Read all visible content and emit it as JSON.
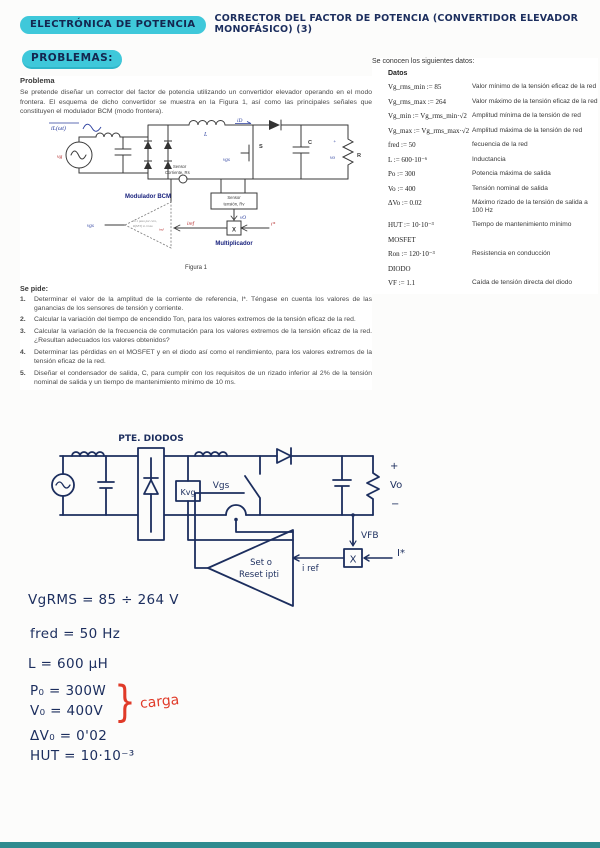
{
  "header": {
    "course": "ELECTRÓNICA DE POTENCIA",
    "title": "CORRECTOR DEL FACTOR DE POTENCIA (CONVERTIDOR ELEVADOR MONOFÁSICO) (3)",
    "section": "PROBLEMAS:"
  },
  "problem": {
    "heading": "Problema",
    "body": "Se pretende diseñar un corrector del factor de potencia utilizando un convertidor elevador operando en el modo frontera. El esquema de dicho convertidor se muestra en la Figura 1, así como las principales señales que constituyen el modulador BCM (modo frontera).",
    "figure": {
      "caption": "Figura 1",
      "labels": {
        "il": "iL(ωt)",
        "vg": "vg",
        "L": "L",
        "id": "iD",
        "S": "S",
        "vgs": "vgs",
        "C": "C",
        "vo": "vo",
        "plus": "+",
        "R": "R",
        "sensor_i_1": "Sensor",
        "sensor_i_2": "Corriente, Rs",
        "sensor_v_1": "Sensor",
        "sensor_v_2": "tensión, Rv",
        "vO": "vO",
        "modulador": "Modulador BCM",
        "mod_line1": "S=1 paso por cero,",
        "mod_line2": "R(SET) si cruza",
        "mod_iref": "iref",
        "iref": "iref",
        "istar": "i*",
        "x": "X",
        "multiplicador": "Multiplicador"
      }
    },
    "se_pide": {
      "heading": "Se pide:",
      "items": [
        {
          "num": "1.",
          "text": "Determinar el valor de la amplitud de la corriente de referencia, I*. Téngase en cuenta los valores de las ganancias de los sensores de tensión y corriente."
        },
        {
          "num": "2.",
          "text": "Calcular la variación del tiempo de encendido Ton, para los valores extremos de la tensión eficaz de la red."
        },
        {
          "num": "3.",
          "text": "Calcular la variación de la frecuencia de conmutación para los valores extremos de la tensión eficaz de la red. ¿Resultan adecuados los valores obtenidos?"
        },
        {
          "num": "4.",
          "text": "Determinar las pérdidas en el MOSFET y en el diodo así como el rendimiento, para los valores extremos de la tensión eficaz de la red."
        },
        {
          "num": "5.",
          "text": "Diseñar el condensador de salida, C, para cumplir con los requisitos de un rizado inferior al 2% de la tensión nominal de salida y un tiempo de mantenimiento mínimo de 10 ms."
        }
      ]
    }
  },
  "data_panel": {
    "heading": "Se conocen los siguientes datos:",
    "subheading": "Datos",
    "rows": [
      {
        "expr": "Vg_rms_min := 85",
        "desc": "Valor mínimo de la tensión eficaz de la red"
      },
      {
        "expr": "Vg_rms_max := 264",
        "desc": "Valor máximo de la tensión eficaz de la red"
      },
      {
        "expr": "Vg_min := Vg_rms_min·√2",
        "desc": "Amplitud mínima de la tensión de red"
      },
      {
        "expr": "Vg_max := Vg_rms_max·√2",
        "desc": "Amplitud máxima de la tensión de red"
      },
      {
        "expr": "fred := 50",
        "desc": "fecuencia de la red"
      },
      {
        "expr": "L := 600·10⁻⁶",
        "desc": "Inductancia"
      },
      {
        "expr": "Po := 300",
        "desc": "Potencia máxima de salida"
      },
      {
        "expr": "Vo := 400",
        "desc": "Tensión nominal de salida"
      },
      {
        "expr": "ΔVo := 0.02",
        "desc": "Máximo rizado de la tensión de salida a 100 Hz"
      },
      {
        "expr": "HUT := 10·10⁻³",
        "desc": "Tiempo de mantenimiento mínimo"
      },
      {
        "expr": "MOSFET",
        "desc": ""
      },
      {
        "expr": "Ron := 120·10⁻³",
        "desc": "Resistencia en conducción"
      },
      {
        "expr": "DIODO",
        "desc": ""
      },
      {
        "expr": "VF := 1.1",
        "desc": "Caída de tensión directa del diodo"
      }
    ]
  },
  "sketch": {
    "labels": {
      "pte_diodos": "PTE. DIODOS",
      "kvg": "Kvg",
      "vgs": "Vgs",
      "plus": "+",
      "vo": "Vo",
      "minus": "−",
      "vfb": "VFB",
      "x": "X",
      "istar": "I*",
      "iref": "i ref",
      "comp_line1": "Set o",
      "comp_line2": "Reset ipti"
    }
  },
  "notes": {
    "vgrms": "VgRMS = 85 ÷ 264 V",
    "fred": "fred = 50 Hz",
    "l": "L = 600 μH",
    "po": "P₀ = 300W",
    "vo": "V₀ = 400V",
    "brace": "}",
    "carga": "carga",
    "dvo": "ΔV₀ = 0'02",
    "hut": "HUT = 10·10⁻³"
  },
  "colors": {
    "ink_navy": "#1c2e5e",
    "highlight_cyan": "#3fc8da",
    "ink_red": "#e03a28",
    "figure_blue": "#2b3f9e",
    "figure_red": "#b02020",
    "footer_teal": "#2e8b8f"
  }
}
